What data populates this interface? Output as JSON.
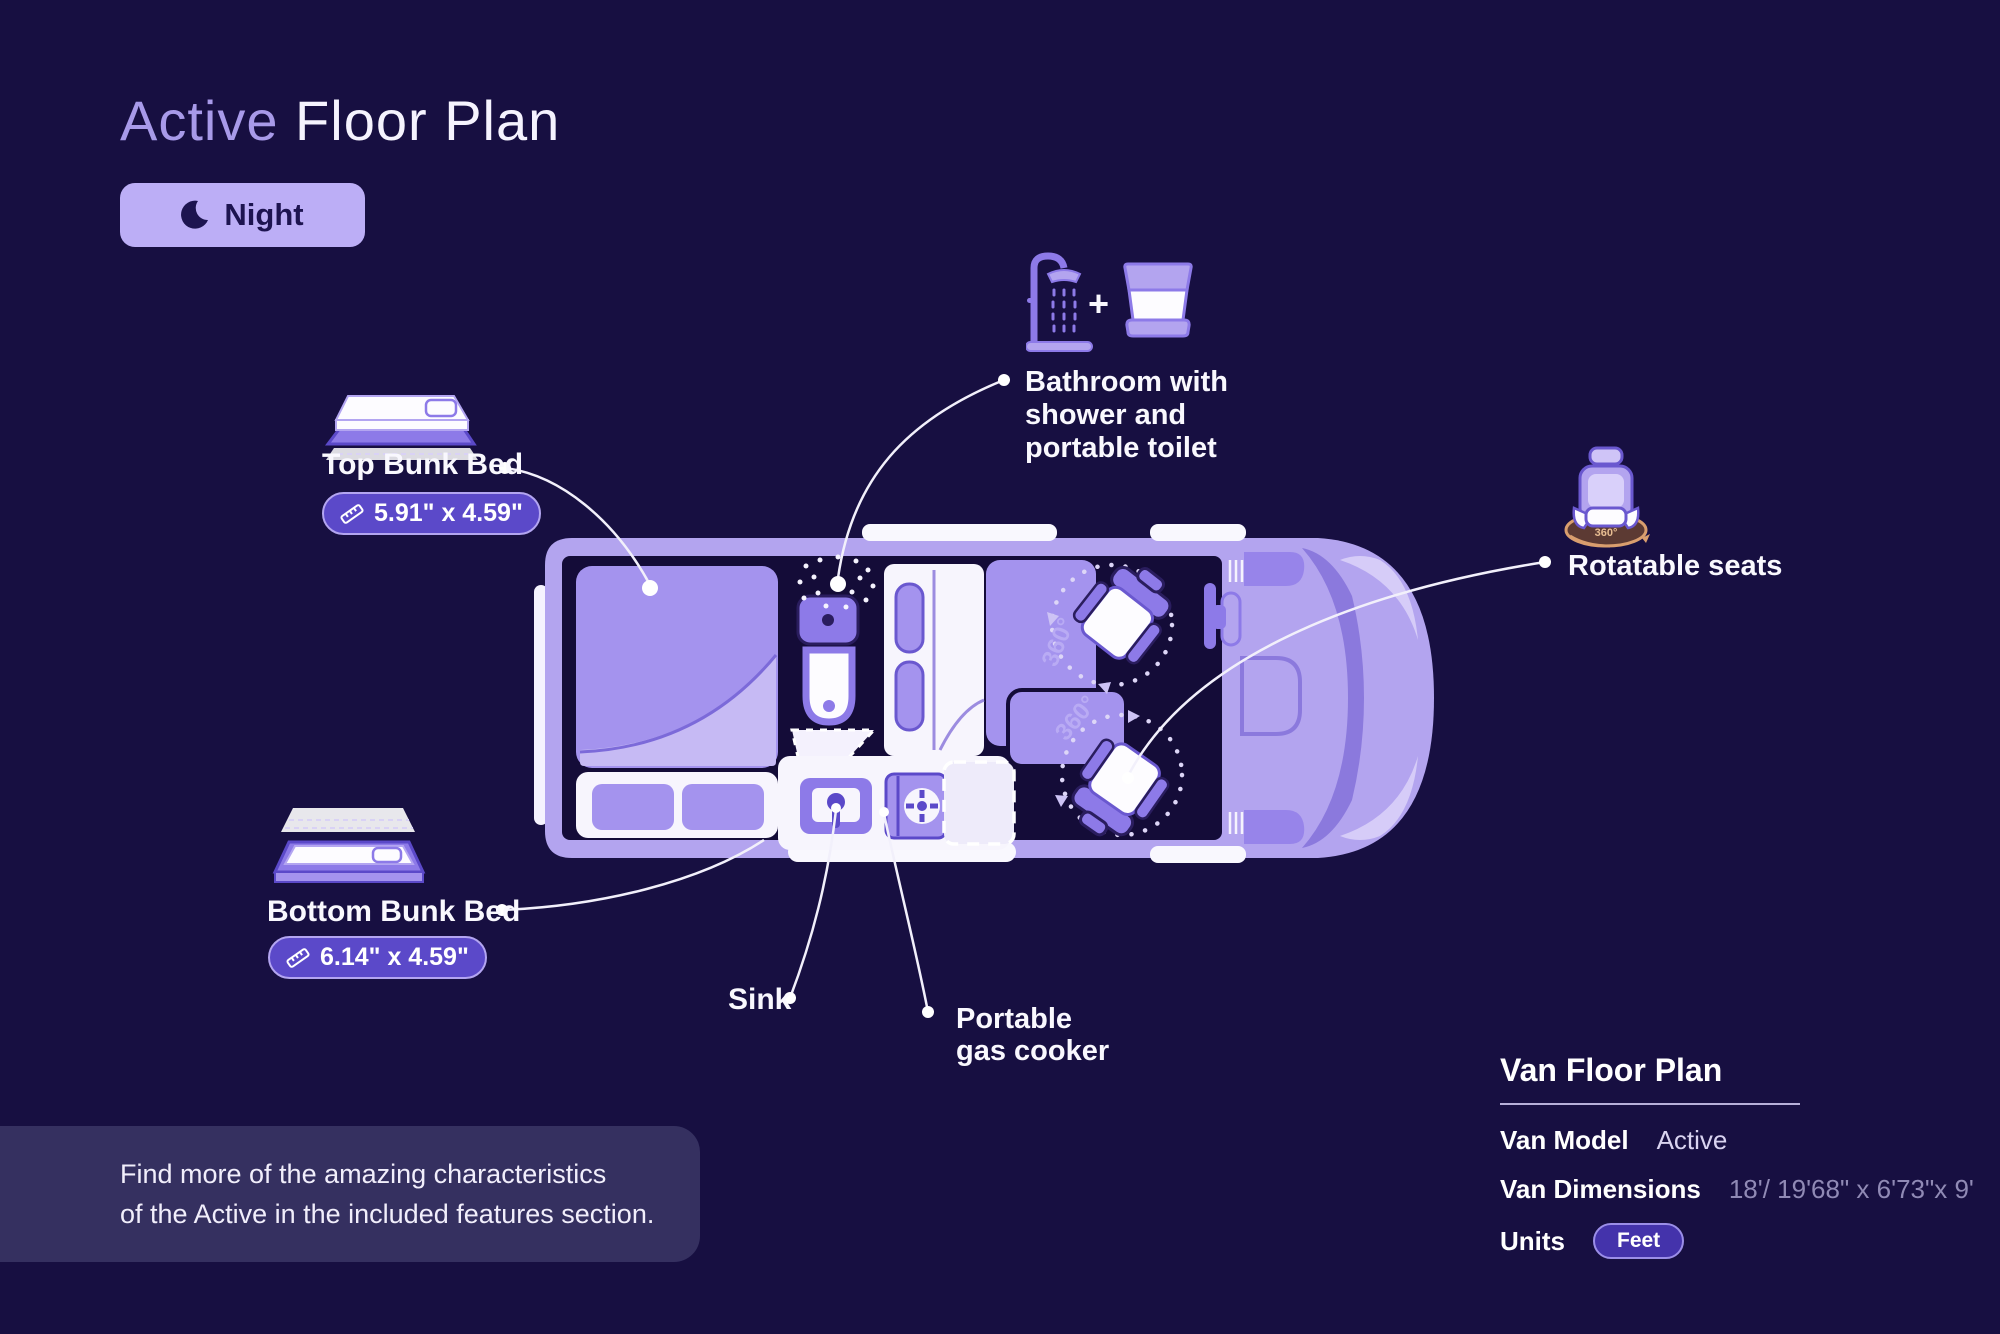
{
  "title": {
    "highlight": "Active",
    "rest": " Floor Plan"
  },
  "mode": {
    "label": "Night"
  },
  "callouts": {
    "top_bunk": {
      "label": "Top Bunk Bed",
      "size": "5.91\" x 4.59\""
    },
    "bottom_bunk": {
      "label": "Bottom Bunk Bed",
      "size": "6.14\" x 4.59\""
    },
    "bathroom": {
      "line1": "Bathroom with",
      "line2": "shower and",
      "line3": "portable toilet",
      "plus": "+"
    },
    "seats": {
      "label": "Rotatable seats",
      "badge": "360°"
    },
    "sink": {
      "label": "Sink"
    },
    "cooker": {
      "line1": "Portable",
      "line2": "gas cooker"
    }
  },
  "plan": {
    "rotation1": "360°",
    "rotation2": "360°"
  },
  "note": {
    "line1": "Find more of the amazing characteristics",
    "line2": "of the Active in the included features section."
  },
  "panel": {
    "heading": "Van Floor Plan",
    "model_label": "Van Model",
    "model_value": "Active",
    "dims_label": "Van Dimensions",
    "dims_value": "18'/ 19'68\" x 6'73\"x 9'",
    "units_label": "Units",
    "units_value": "Feet"
  },
  "colors": {
    "background": "#170f41",
    "van_body": "#b3a4ef",
    "interior": "#140c38",
    "accent_purple": "#8d7ae8",
    "bed_purple": "#a493ee",
    "pill_bg": "#5b49c9",
    "pill_border": "#b3a5f1",
    "night_button_bg": "#bcaef6",
    "dim_text": "#908ab5",
    "seat_base_brown": "#5c3a33",
    "seat_ring_tan": "#d99e6e"
  }
}
